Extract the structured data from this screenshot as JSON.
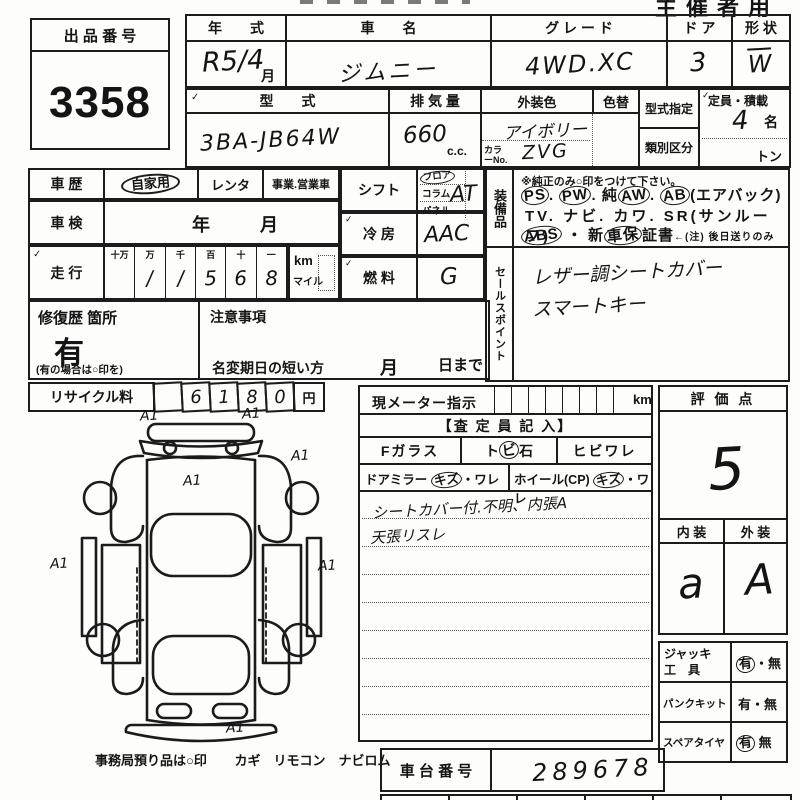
{
  "corner_label": "主催者用",
  "tick": "✓",
  "lot": {
    "label": "出 品 番 号",
    "value": "3358"
  },
  "r1": {
    "nenshiki_l": "年　　式",
    "nenshiki_v": "R5/4",
    "tsuki": "月",
    "shamei_l": "車　　名",
    "shamei_v": "ジムニー",
    "grade_l": "グ レ ー ド",
    "grade_v": "4WD.XC",
    "door_l": "ド ア",
    "door_v": "3",
    "keijo_l": "形 状",
    "keijo_v": "W"
  },
  "r2": {
    "katashiki_l": "型　　式",
    "katashiki_v": "3BA-JB64W",
    "haiki_l": "排 気 量",
    "haiki_v": "660",
    "cc": "c.c.",
    "gaiso_l": "外装色",
    "gaiso_v": "アイボリー",
    "colorno_l": "カラーNo.",
    "colorno_v": "ZVG",
    "irogae_l": "色替",
    "shitei_l": "型式指定",
    "ruibetsu_l": "類別区分",
    "teiin_l": "定員・積載",
    "teiin_v": "4",
    "mei": "名",
    "ton": "トン"
  },
  "hist": {
    "shareki_l": "車 歴",
    "jikayo": "自家用",
    "renta": "レンタ",
    "jigyo": "事業.営業車",
    "shaken_l": "車 検",
    "year": "年",
    "month": "月",
    "soko_l": "走 行",
    "d_h": [
      "十万",
      "万",
      "千",
      "百",
      "十",
      "一"
    ],
    "d_v": [
      "",
      "/",
      "/",
      "5",
      "6",
      "8"
    ],
    "km": "km",
    "mile": "マイル"
  },
  "mid": {
    "shift_l": "シフト",
    "floor": "フロア",
    "column": "コラム",
    "panel": "パネル",
    "shift_v": "AT",
    "reibo_l": "冷 房",
    "reibo_v": "AAC",
    "nenryo_l": "燃 料",
    "nenryo_v": "G"
  },
  "equip": {
    "label": "装備品",
    "note": "※純正のみ○印をつけて下さい。",
    "l1": [
      "PS",
      ". ",
      "PW",
      ". 純",
      "AW",
      ". ",
      "AB",
      "(エアバック)"
    ],
    "l2": "TV. ナビ. カワ. SR(サンルーフ)",
    "l3": [
      "ABS",
      " ・ 新",
      "車保",
      "証書",
      "←(注) 後日送りのみ"
    ]
  },
  "sales": {
    "label": "セールスポイント",
    "line1": "レザー調シートカバー",
    "line2": "スマートキー"
  },
  "repair": {
    "label": "修復歴 箇所",
    "value": "有",
    "note": "(有の場合は○印を)"
  },
  "caution": {
    "label": "注意事項",
    "meihen": "名変期日の短い方",
    "month": "月",
    "day": "日まで"
  },
  "recycle": {
    "label": "リサイクル料",
    "digits": [
      "",
      "6",
      "1",
      "8",
      "0"
    ],
    "yen": "円"
  },
  "meter": {
    "label": "現メーター指示",
    "km": "km"
  },
  "satei": {
    "header": "【査 定 員 記 入】",
    "fglass": "Fガラス",
    "tobi": [
      "ト",
      "ビ",
      "石"
    ],
    "hibi": "ヒビワレ",
    "mirror": [
      "ドアミラー ",
      "キズ",
      "・ワレ"
    ],
    "wheel": [
      "ホイール(CP) ",
      "キズ",
      "・ワレ"
    ],
    "note1": "シートカバー付.不明、内張A",
    "note2": "天張リスレ"
  },
  "rating": {
    "label": "評 価 点",
    "value": "5",
    "naiso_l": "内 装",
    "gaiso_l": "外 装",
    "naiso_v": "a",
    "gaiso_v": "A"
  },
  "tools": {
    "jack_l1": "ジャッキ",
    "jack_l2": "工　具",
    "jack_ari": "有",
    "jack_sep": "・",
    "jack_nashi": "無",
    "punk_l": "パンクキット",
    "punk_ari": "有",
    "punk_sep": "・",
    "punk_nashi": "無",
    "spare_l": "スペアタイヤ",
    "spare_ari": "有",
    "spare_nashi": "無"
  },
  "chassis": {
    "label": "車 台 番 号",
    "value": "289678"
  },
  "office": {
    "label": "事務局預り品は○印",
    "items": "カギ　リモコン　ナビロム"
  },
  "diagram": {
    "annotations": [
      "A1",
      "A1",
      "A1",
      "A1",
      "A1",
      "A1",
      "A1"
    ]
  }
}
